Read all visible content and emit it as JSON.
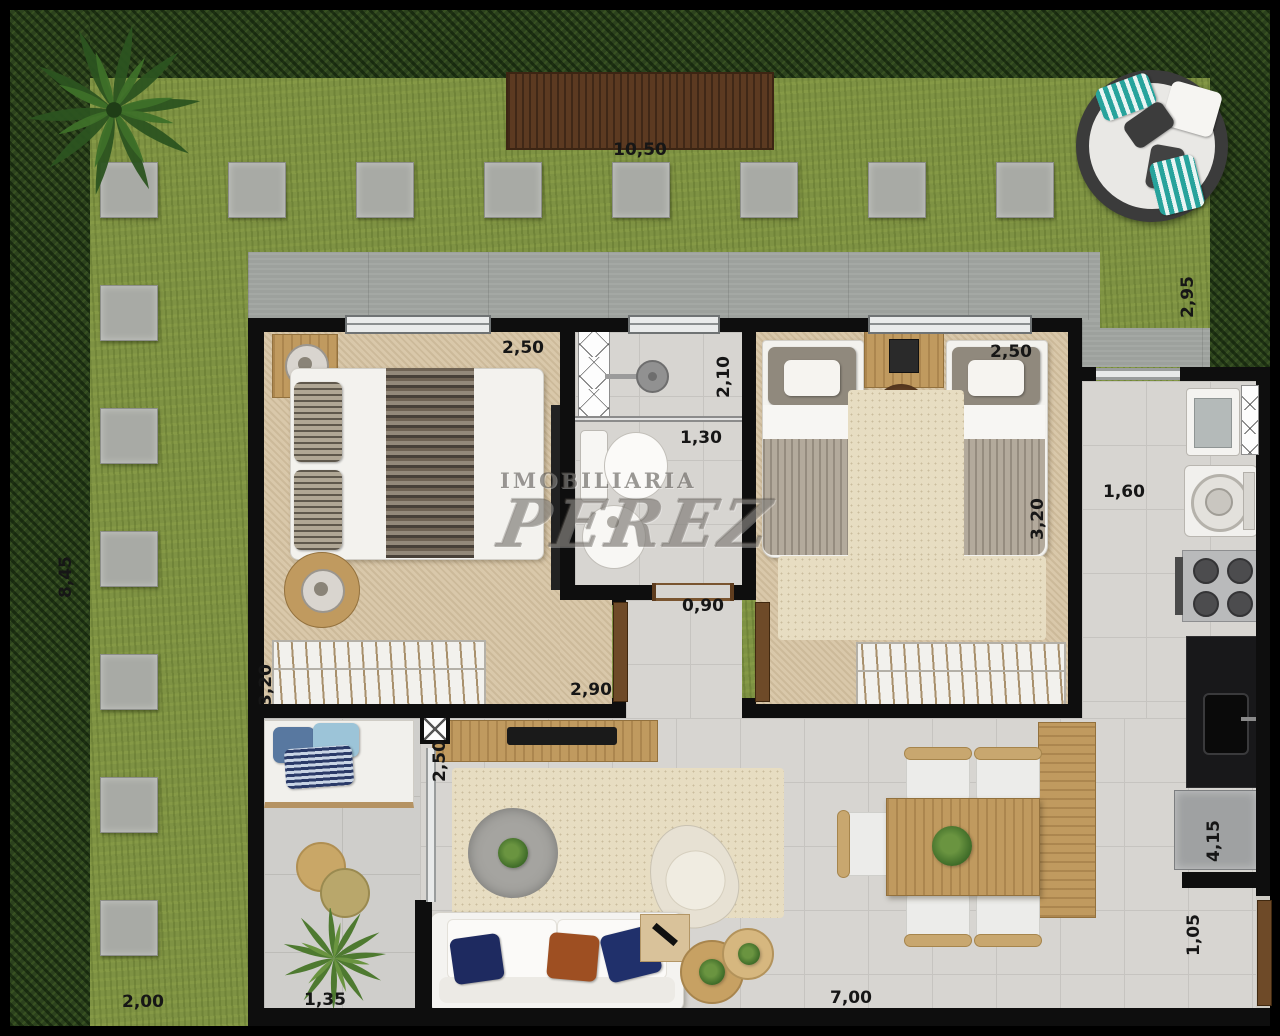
{
  "watermark": {
    "line1": "IMOBILIARIA",
    "line2": "PEREZ"
  },
  "dimensions": {
    "garden_top": "10,50",
    "garden_right": "2,95",
    "garden_left": "8,45",
    "garden_bottom": "2,00",
    "bedroom1_width": "2,50",
    "bedroom1_closet": "3,20",
    "bathroom_length": "2,10",
    "bathroom_width": "1,30",
    "hall_door": "0,90",
    "hall_length": "2,90",
    "bedroom2_width": "2,50",
    "bedroom2_depth": "3,20",
    "kitchen_hall": "1,60",
    "living_tv_wall": "2,50",
    "kitchen_run": "4,15",
    "entry_nook": "1,05",
    "patio_width": "1,35",
    "living_width": "7,00"
  }
}
